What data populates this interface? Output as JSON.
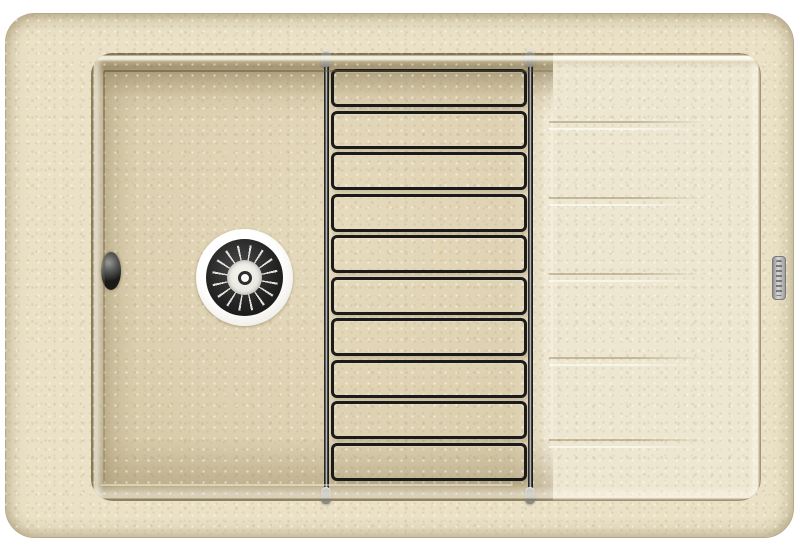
{
  "scene": {
    "type": "product-photo",
    "subject": "Beige granite composite kitchen sink with left basin, right drainboard, chrome basket-strainer drain and black wire dish rack",
    "background_color": "#ffffff"
  },
  "sink": {
    "body_color": "#eae1c6",
    "edge_color": "#b7aa8c",
    "basin": {
      "floor_color": "#ddd1b1",
      "wall_shadow_color": "#a39577"
    },
    "drainboard": {
      "surface_color": "#ede6d1",
      "groove_count": 5,
      "groove_offsets_px": [
        68,
        144,
        220,
        304,
        386
      ]
    },
    "drain": {
      "ring_color": "#f0efe9",
      "strainer_color": "#242424",
      "center_color": "#e9e7e0",
      "spoke_count": 16
    },
    "overflow_color": "#1a1a1a",
    "badge_color": "#c0c0be"
  },
  "rack": {
    "wire_color": "#1b1b1b",
    "cap_color": "#a6a6a4",
    "rung_count": 10,
    "rail_count": 2,
    "cap_count": 4
  }
}
